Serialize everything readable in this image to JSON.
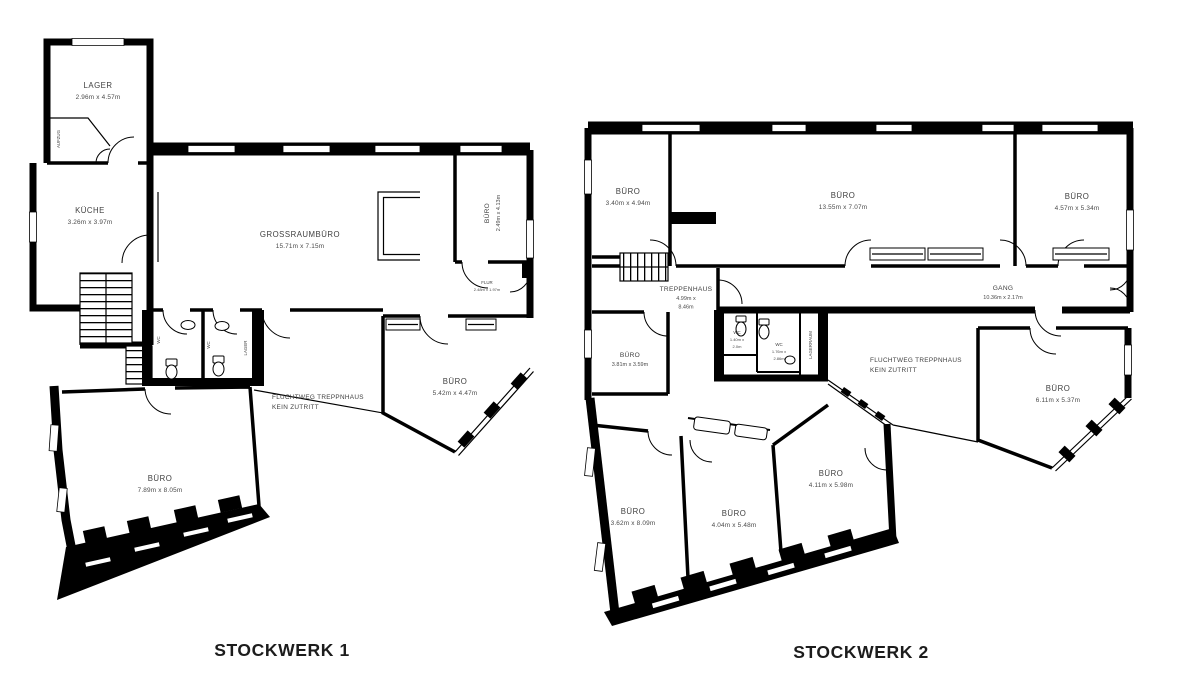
{
  "colors": {
    "walls": "#000000",
    "room_label": "#3f3f3f",
    "caption": "#1c1c1c",
    "background": "#ffffff"
  },
  "floor1": {
    "caption": "STOCKWERK 1",
    "rooms": {
      "lager": {
        "name": "LAGER",
        "dims": "2.96m x 4.57m"
      },
      "aufzug": {
        "name": "AUFZUG"
      },
      "kueche": {
        "name": "KÜCHE",
        "dims": "3.26m x 3.97m"
      },
      "grossraumbuero": {
        "name": "GROSSRAUMBÜRO",
        "dims": "15.71m x 7.15m"
      },
      "buero_nordost": {
        "name": "BÜRO",
        "dims": "2.49m x 4.13m"
      },
      "flur": {
        "name": "FLUR",
        "dims": "2.48m x 1.97m"
      },
      "wc_links": {
        "name": "WC"
      },
      "wc_rechts": {
        "name": "WC"
      },
      "lager_klein": {
        "name": "LAGER"
      },
      "fluchtweg": {
        "line1": "FLUCHTWEG TREPPNHAUS",
        "line2": "KEIN ZUTRITT"
      },
      "buero_suedost": {
        "name": "BÜRO",
        "dims": "5.42m x 4.47m"
      },
      "buero_suedwest": {
        "name": "BÜRO",
        "dims": "7.89m x 8.05m"
      }
    }
  },
  "floor2": {
    "caption": "STOCKWERK 2",
    "rooms": {
      "buero_nordwest": {
        "name": "BÜRO",
        "dims": "3.40m x 4.94m"
      },
      "buero_nord": {
        "name": "BÜRO",
        "dims": "13.55m x 7.07m"
      },
      "buero_nordost": {
        "name": "BÜRO",
        "dims": "4.57m x 5.34m"
      },
      "treppenhaus": {
        "name": "TREPPENHAUS",
        "dims_line1": "4.99m x",
        "dims_line2": "8.46m"
      },
      "gang": {
        "name": "GANG",
        "dims": "10.36m x 2.17m"
      },
      "buero_west": {
        "name": "BÜRO",
        "dims": "3.81m x 3.59m"
      },
      "wc_links": {
        "name": "WC",
        "dims_line1": "1.40m x",
        "dims_line2": "2.0m"
      },
      "wc_rechts": {
        "name": "WC",
        "dims_line1": "1.76m x",
        "dims_line2": "2.86m"
      },
      "lagerraum": {
        "name": "LAGERRAUM"
      },
      "fluchtweg": {
        "line1": "FLUCHTWEG TREPPNHAUS",
        "line2": "KEIN ZUTRITT"
      },
      "buero_ost": {
        "name": "BÜRO",
        "dims": "6.11m x 5.37m"
      },
      "buero_suedwest": {
        "name": "BÜRO",
        "dims": "3.62m x 8.09m"
      },
      "buero_sued": {
        "name": "BÜRO",
        "dims": "4.04m x 5.48m"
      },
      "buero_suedost": {
        "name": "BÜRO",
        "dims": "4.11m x 5.98m"
      }
    }
  }
}
